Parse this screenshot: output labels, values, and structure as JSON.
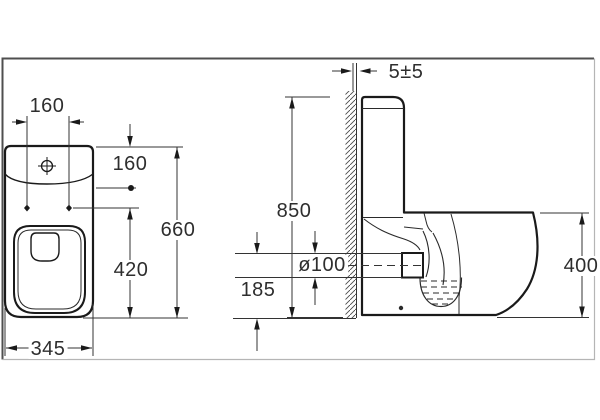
{
  "drawing": {
    "type": "technical-dimension-drawing",
    "subject": "close-coupled toilet, front and side elevations with installation dimensions",
    "labels": {
      "dim_160_top": "160",
      "dim_160_inlet": "160",
      "dim_660": "660",
      "dim_420": "420",
      "dim_345": "345",
      "dim_gap": "5±5",
      "dim_850": "850",
      "dim_185": "185",
      "dim_outlet": "ø100",
      "dim_400": "400"
    },
    "views": [
      {
        "name": "front-elevation",
        "dimension_values": [
          "160",
          "160",
          "660",
          "420",
          "345"
        ]
      },
      {
        "name": "side-elevation",
        "dimension_values": [
          "5±5",
          "850",
          "185",
          "ø100",
          "400"
        ]
      }
    ],
    "colors": {
      "background": "#ffffff",
      "outline": "#1a1a1a",
      "dimension_line": "#333333",
      "border_dark": "#4f4f4f",
      "border_light": "#b5b5b5"
    }
  }
}
